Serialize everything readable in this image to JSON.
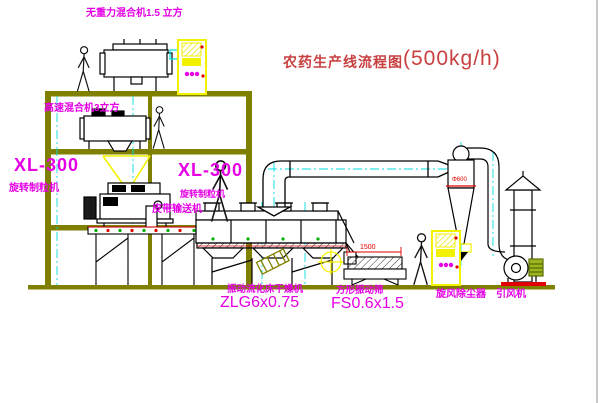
{
  "title": {
    "name": "农药生产线流程图",
    "capacity": "(500kg/h)"
  },
  "equipment": {
    "top_mixer_label": "无重力混合机1.5 立方",
    "mid_mixer_label": "高速混合机3立方",
    "granulator_left": {
      "model": "XL-300",
      "name": "旋转制粒机"
    },
    "granulator_right": {
      "model": "XL-300",
      "name": "旋转制粒机"
    },
    "belt_conveyor_label": "皮带输送机",
    "dryer": {
      "name": "振动流化床干燥机",
      "model": "ZLG6x0.75"
    },
    "sieve": {
      "name": "方形振动筛",
      "model": "FS0.6x1.5"
    },
    "cyclone_label": "旋风除尘器",
    "fan_label": "引风机"
  },
  "dimensions": {
    "cyclone_diameter": "Φ600",
    "sieve_length": "1500"
  },
  "colors": {
    "label_magenta": "#e500e5",
    "title_red": "#c84040",
    "structure_olive": "#808000",
    "centerline_cyan": "#00dede",
    "cabinet_yellow": "#f2f200",
    "alert_red": "#e00000",
    "machine_black": "#000000",
    "dot_green": "#00b000"
  }
}
